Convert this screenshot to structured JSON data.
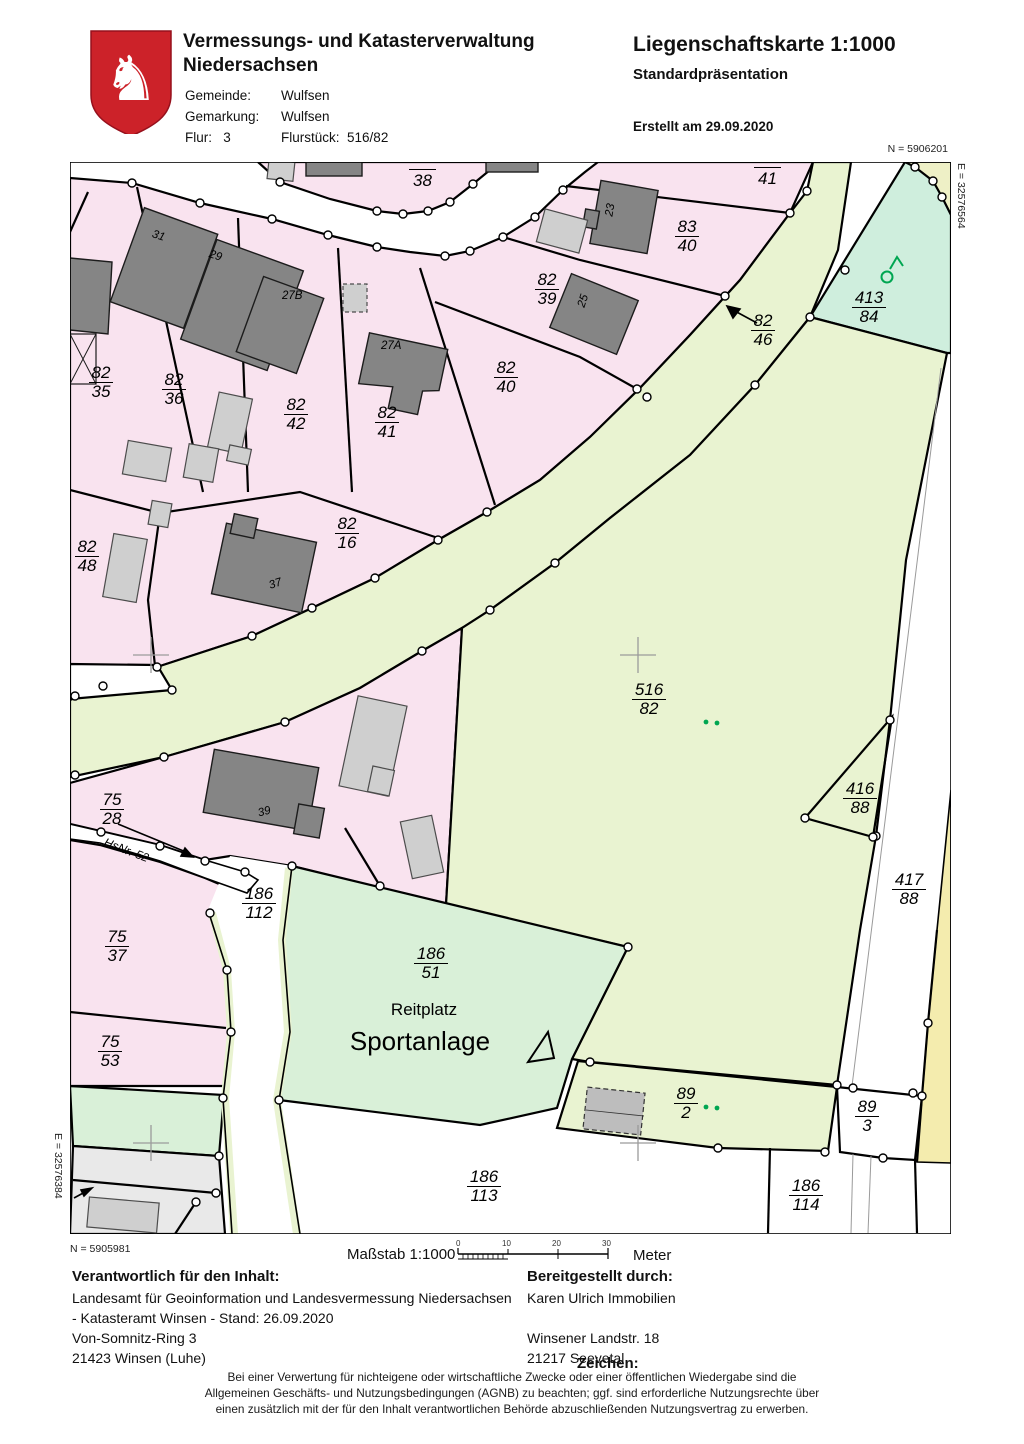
{
  "header": {
    "agency_line1": "Vermessungs- und Katasterverwaltung",
    "agency_line2": "Niedersachsen",
    "meta": {
      "gemeinde_label": "Gemeinde:",
      "gemeinde": "Wulfsen",
      "gemarkung_label": "Gemarkung:",
      "gemarkung": "Wulfsen",
      "flur_label": "Flur:",
      "flur": "3",
      "flurstueck_label": "Flurstück:",
      "flurstueck": "516/82"
    },
    "doc_title": "Liegenschaftskarte 1:1000",
    "doc_subtitle": "Standardpräsentation",
    "created": "Erstellt am 29.09.2020"
  },
  "map": {
    "corner_coordinates": {
      "top_right_n": "N = 5906201",
      "right_e": "E = 32576564",
      "bottom_left_n": "N = 5905981",
      "left_e": "E = 32576384"
    },
    "road_labels": {
      "p38": "38",
      "p41": "41"
    },
    "parcels": [
      {
        "num": "83",
        "den": "40"
      },
      {
        "num": "82",
        "den": "39"
      },
      {
        "num": "82",
        "den": "46"
      },
      {
        "num": "413",
        "den": "84"
      },
      {
        "num": "82",
        "den": "35"
      },
      {
        "num": "82",
        "den": "36"
      },
      {
        "num": "82",
        "den": "42"
      },
      {
        "num": "82",
        "den": "41"
      },
      {
        "num": "82",
        "den": "40"
      },
      {
        "num": "82",
        "den": "48"
      },
      {
        "num": "82",
        "den": "16"
      },
      {
        "num": "516",
        "den": "82"
      },
      {
        "num": "416",
        "den": "88"
      },
      {
        "num": "417",
        "den": "88"
      },
      {
        "num": "75",
        "den": "28"
      },
      {
        "num": "186",
        "den": "112"
      },
      {
        "num": "75",
        "den": "37"
      },
      {
        "num": "186",
        "den": "51"
      },
      {
        "num": "75",
        "den": "53"
      },
      {
        "num": "89",
        "den": "2"
      },
      {
        "num": "89",
        "den": "3"
      },
      {
        "num": "186",
        "den": "113"
      },
      {
        "num": "186",
        "den": "114"
      }
    ],
    "house_numbers": [
      "31",
      "29",
      "27B",
      "27A",
      "25",
      "23",
      "37",
      "39"
    ],
    "place_labels": {
      "reitplatz": "Reitplatz",
      "sportanlage": "Sportanlage",
      "hsnr": "HsNr. 52"
    },
    "colors": {
      "parcel_pink": "#f9e3ef",
      "parcel_lightgreen": "#e9f3d1",
      "parcel_mint": "#d9f0d8",
      "parcel_teal": "#cfeedd",
      "parcel_yellow": "#f4ecae",
      "building_gray": "#858585",
      "tree_green": "#00a651",
      "shield_red": "#cc2229"
    }
  },
  "footer": {
    "massstab": "Maßstab  1:1000",
    "scale_ticks": [
      "0",
      "10",
      "20",
      "30"
    ],
    "meter": "Meter",
    "responsible_heading": "Verantwortlich für den Inhalt:",
    "responsible_lines": [
      "Landesamt für Geoinformation und Landesvermessung Niedersachsen",
      "- Katasteramt Winsen - Stand: 26.09.2020",
      "Von-Somnitz-Ring 3",
      "21423 Winsen (Luhe)"
    ],
    "provided_heading": "Bereitgestellt durch:",
    "provided_lines": [
      "Karen Ulrich Immobilien",
      "Winsener Landstr. 18",
      "21217 Seevetal"
    ],
    "zeichen": "Zeichen:",
    "disclaimer_lines": [
      "Bei einer Verwertung für nichteigene oder wirtschaftliche Zwecke oder einer öffentlichen Wiedergabe sind die",
      "Allgemeinen Geschäfts- und Nutzungsbedingungen (AGNB) zu beachten; ggf. sind erforderliche Nutzungsrechte über",
      "einen zusätzlich mit der für den Inhalt verantwortlichen Behörde abzuschließenden Nutzungsvertrag zu erwerben."
    ]
  }
}
